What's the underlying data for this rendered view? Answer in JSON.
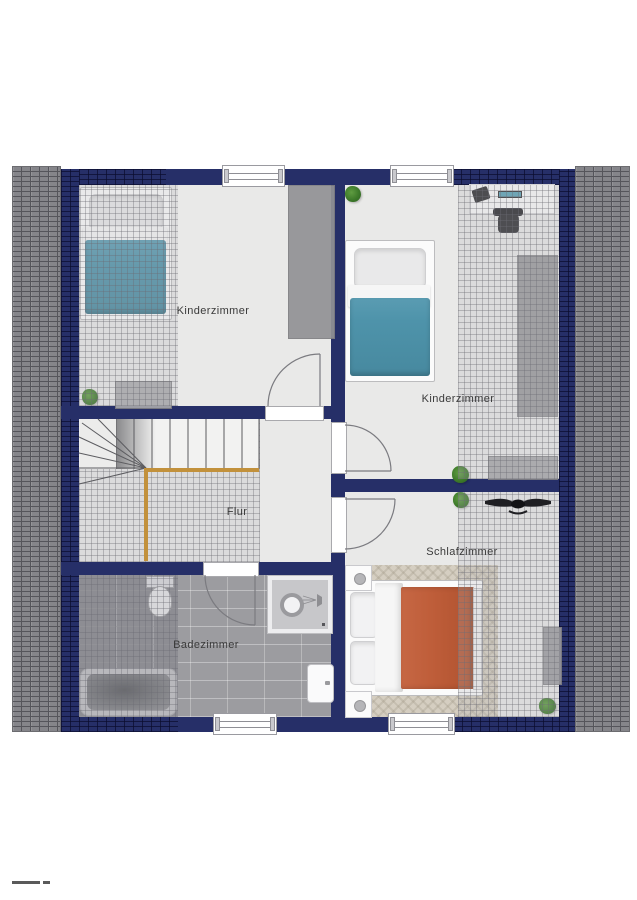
{
  "plan": {
    "type": "floorplan",
    "language": "de",
    "rooms": [
      {
        "key": "kinderzimmer_left",
        "label": "Kinderzimmer"
      },
      {
        "key": "kinderzimmer_right",
        "label": "Kinderzimmer"
      },
      {
        "key": "flur",
        "label": "Flur"
      },
      {
        "key": "schlafzimmer",
        "label": "Schlafzimmer"
      },
      {
        "key": "badezimmer",
        "label": "Badezimmer"
      }
    ],
    "furniture": [
      "single-bed-teal-left",
      "single-bed-teal-right",
      "double-bed-orange",
      "wardrobe",
      "dresser",
      "sideboard",
      "desk-with-chair",
      "ceiling-fan",
      "nightstand-top",
      "nightstand-bottom",
      "rug",
      "stairs-with-railing",
      "bathtub",
      "shower",
      "toilet",
      "sink",
      "plants"
    ],
    "colors": {
      "wall": "#262f68",
      "roof_tiles": "#85858a",
      "floor": "#e9e9e8",
      "bath_tiles": "#9c9ca0",
      "accent_teal": "#4e93aa",
      "accent_orange": "#bf5e3a",
      "railing_wood": "#c2913c",
      "rug": "#d5cec1",
      "label_text": "#3a3a3a"
    }
  }
}
